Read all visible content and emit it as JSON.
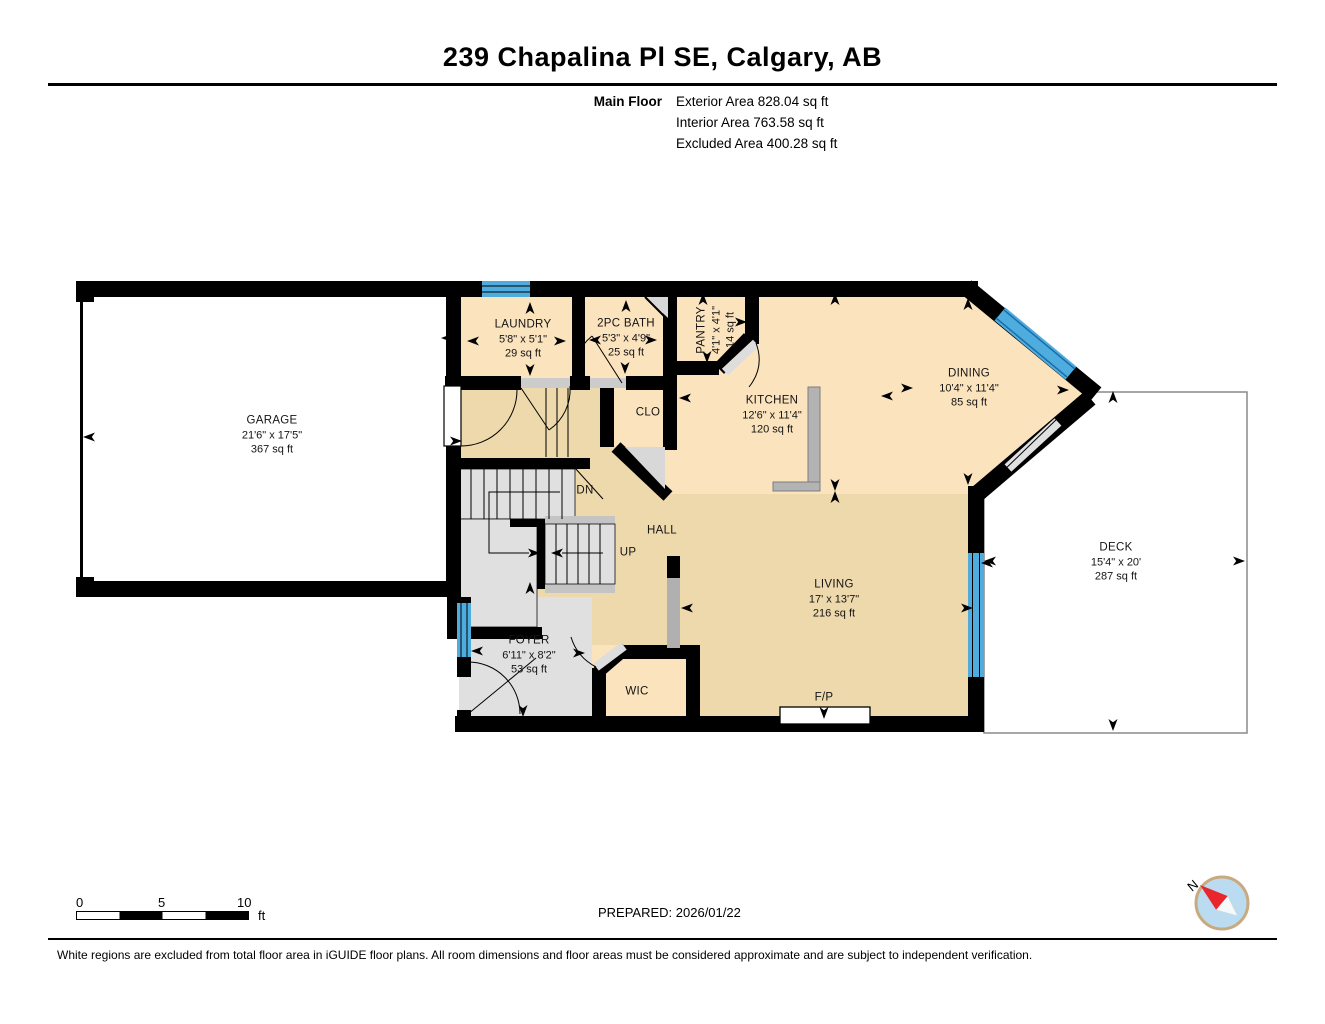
{
  "header": {
    "title": "239 Chapalina Pl SE, Calgary, AB",
    "floor_label": "Main Floor",
    "stats": [
      "Exterior Area 828.04 sq ft",
      "Interior Area 763.58 sq ft",
      "Excluded Area 400.28 sq ft"
    ]
  },
  "plan": {
    "colors": {
      "wall": "#000000",
      "warm": "#FBE3BE",
      "hall": "#EDD9AC",
      "stairs": "#E0E0E0",
      "window": "#4FACDF",
      "excluded": "#FFFFFF",
      "compass_red": "#E8262B",
      "compass_blue": "#BBDCF0",
      "compass_ring": "#C9A97F"
    },
    "rooms": [
      {
        "name": "GARAGE",
        "dims": "21'6\" x 17'5\"",
        "area": "367 sq ft",
        "x": 272,
        "y": 435,
        "rot": 0
      },
      {
        "name": "LAUNDRY",
        "dims": "5'8\" x 5'1\"",
        "area": "29 sq ft",
        "x": 523,
        "y": 339,
        "rot": 0
      },
      {
        "name": "2PC BATH",
        "dims": "5'3\" x 4'9\"",
        "area": "25 sq ft",
        "x": 626,
        "y": 338,
        "rot": 0
      },
      {
        "name": "PANTRY",
        "dims": "4'1\" x 4'1\"",
        "area": "14 sq ft",
        "x": 716,
        "y": 330,
        "rot": -90
      },
      {
        "name": "KITCHEN",
        "dims": "12'6\" x 11'4\"",
        "area": "120 sq ft",
        "x": 772,
        "y": 415,
        "rot": 0
      },
      {
        "name": "DINING",
        "dims": "10'4\" x 11'4\"",
        "area": "85 sq ft",
        "x": 969,
        "y": 388,
        "rot": 0
      },
      {
        "name": "HALL",
        "dims": "",
        "area": "",
        "x": 662,
        "y": 531,
        "rot": 0
      },
      {
        "name": "LIVING",
        "dims": "17' x 13'7\"",
        "area": "216 sq ft",
        "x": 834,
        "y": 599,
        "rot": 0
      },
      {
        "name": "FOYER",
        "dims": "6'11\" x 8'2\"",
        "area": "53 sq ft",
        "x": 529,
        "y": 655,
        "rot": 0
      },
      {
        "name": "WIC",
        "dims": "",
        "area": "",
        "x": 637,
        "y": 692,
        "rot": 0
      },
      {
        "name": "CLO",
        "dims": "",
        "area": "",
        "x": 648,
        "y": 413,
        "rot": 0
      },
      {
        "name": "DECK",
        "dims": "15'4\" x 20'",
        "area": "287 sq ft",
        "x": 1116,
        "y": 562,
        "rot": 0
      },
      {
        "name": "DN",
        "dims": "",
        "area": "",
        "x": 585,
        "y": 491,
        "rot": 0
      },
      {
        "name": "UP",
        "dims": "",
        "area": "",
        "x": 628,
        "y": 553,
        "rot": 0
      },
      {
        "name": "F/P",
        "dims": "",
        "area": "",
        "x": 824,
        "y": 698,
        "rot": 0
      }
    ],
    "arrows": [
      [
        277,
        292,
        0
      ],
      [
        90,
        437,
        270
      ],
      [
        277,
        586,
        180
      ],
      [
        448,
        338,
        270
      ],
      [
        530,
        309,
        0
      ],
      [
        474,
        341,
        270
      ],
      [
        559,
        341,
        90
      ],
      [
        530,
        369,
        180
      ],
      [
        626,
        307,
        0
      ],
      [
        596,
        340,
        270
      ],
      [
        650,
        340,
        90
      ],
      [
        625,
        367,
        180
      ],
      [
        703,
        300,
        0
      ],
      [
        707,
        356,
        180
      ],
      [
        740,
        322,
        90
      ],
      [
        835,
        300,
        0
      ],
      [
        835,
        484,
        180
      ],
      [
        686,
        398,
        270
      ],
      [
        888,
        396,
        270
      ],
      [
        906,
        388,
        90
      ],
      [
        968,
        305,
        0
      ],
      [
        968,
        478,
        180
      ],
      [
        1062,
        390,
        90
      ],
      [
        1113,
        398,
        0
      ],
      [
        991,
        561,
        270
      ],
      [
        1238,
        561,
        90
      ],
      [
        1113,
        724,
        180
      ],
      [
        988,
        563,
        270
      ],
      [
        966,
        608,
        90
      ],
      [
        824,
        712,
        180
      ],
      [
        688,
        608,
        270
      ],
      [
        835,
        498,
        0
      ],
      [
        478,
        651,
        270
      ],
      [
        578,
        653,
        90
      ],
      [
        523,
        710,
        180
      ],
      [
        530,
        589,
        0
      ],
      [
        455,
        441,
        90
      ],
      [
        533,
        553,
        90
      ],
      [
        558,
        553,
        270
      ]
    ]
  },
  "footer": {
    "scale_ticks": [
      "0",
      "5",
      "10"
    ],
    "scale_unit": "ft",
    "prepared": "PREPARED: 2026/01/22",
    "disclaimer": "White regions are excluded from total floor area in iGUIDE floor plans. All room dimensions and floor areas must be considered approximate and are subject to independent verification.",
    "compass_n": "N"
  }
}
